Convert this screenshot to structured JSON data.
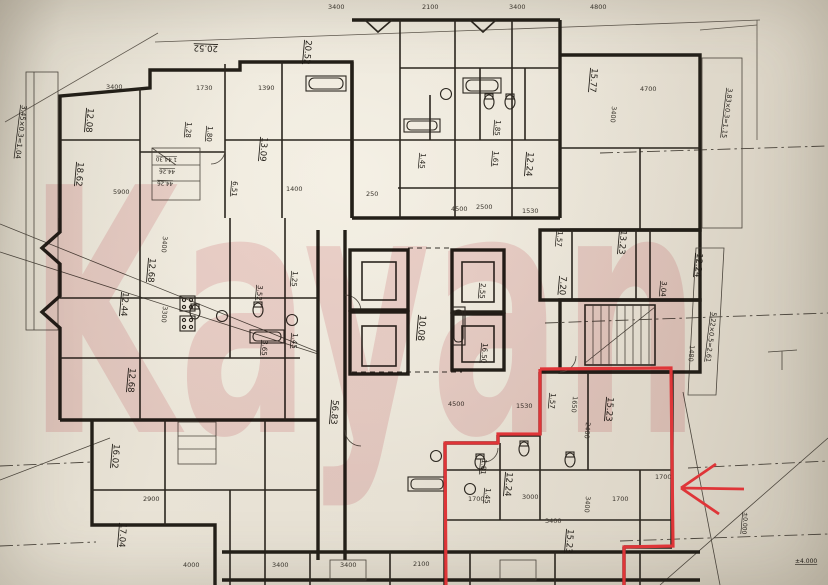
{
  "watermark": {
    "text": "Kayan",
    "color": "#e39da6",
    "opacity": "0.34"
  },
  "annotation": {
    "color": "#df3538"
  },
  "plan": {
    "room_labels": [
      {
        "t": "3.45×0.3=1.04",
        "x": 22,
        "y": 105,
        "r": 97,
        "s": 7
      },
      {
        "t": "12.08",
        "x": 88,
        "y": 108,
        "r": 95,
        "s": 8.5
      },
      {
        "t": "18.62",
        "x": 78,
        "y": 162,
        "r": 95,
        "s": 8.5
      },
      {
        "t": "1.28",
        "x": 187,
        "y": 122,
        "r": 95,
        "s": 7
      },
      {
        "t": "1.80",
        "x": 208,
        "y": 126,
        "r": 95,
        "s": 7
      },
      {
        "t": "13.09",
        "x": 262,
        "y": 137,
        "r": 95,
        "s": 8.5
      },
      {
        "t": "6.51",
        "x": 233,
        "y": 181,
        "r": 95,
        "s": 7
      },
      {
        "t": "20.52",
        "x": 218,
        "y": 46,
        "r": -178,
        "s": 8.5
      },
      {
        "t": "20.52",
        "x": 306,
        "y": 40,
        "r": 95,
        "s": 8.5
      },
      {
        "t": "1 44.30",
        "x": 177,
        "y": 158,
        "r": -178,
        "s": 5.5
      },
      {
        "t": "44.26",
        "x": 175,
        "y": 170,
        "r": -178,
        "s": 5.5
      },
      {
        "t": "44.26",
        "x": 173,
        "y": 182,
        "r": -178,
        "s": 5.5
      },
      {
        "t": "12.68",
        "x": 150,
        "y": 258,
        "r": 95,
        "s": 8.5
      },
      {
        "t": "12.44",
        "x": 123,
        "y": 292,
        "r": 95,
        "s": 8.5
      },
      {
        "t": "12.68",
        "x": 130,
        "y": 368,
        "r": 95,
        "s": 8.5
      },
      {
        "t": "3.52",
        "x": 258,
        "y": 285,
        "r": 95,
        "s": 7
      },
      {
        "t": "1.25",
        "x": 293,
        "y": 271,
        "r": 95,
        "s": 7
      },
      {
        "t": "3.65",
        "x": 263,
        "y": 340,
        "r": 95,
        "s": 7
      },
      {
        "t": "1.45",
        "x": 293,
        "y": 333,
        "r": 95,
        "s": 7
      },
      {
        "t": "56.83",
        "x": 333,
        "y": 400,
        "r": 95,
        "s": 8.5
      },
      {
        "t": "10.08",
        "x": 420,
        "y": 315,
        "r": 95,
        "s": 9
      },
      {
        "t": "2.55",
        "x": 481,
        "y": 283,
        "r": 95,
        "s": 7
      },
      {
        "t": "16.50",
        "x": 483,
        "y": 343,
        "r": 95,
        "s": 7
      },
      {
        "t": "1.85",
        "x": 496,
        "y": 120,
        "r": 95,
        "s": 7
      },
      {
        "t": "1.61",
        "x": 494,
        "y": 151,
        "r": 95,
        "s": 7
      },
      {
        "t": "1.45",
        "x": 421,
        "y": 153,
        "r": 95,
        "s": 7
      },
      {
        "t": "12.24",
        "x": 528,
        "y": 152,
        "r": 95,
        "s": 8.5
      },
      {
        "t": "15.77",
        "x": 592,
        "y": 68,
        "r": 95,
        "s": 8.5
      },
      {
        "t": "1.57",
        "x": 558,
        "y": 231,
        "r": 95,
        "s": 7
      },
      {
        "t": "7.20",
        "x": 561,
        "y": 276,
        "r": 95,
        "s": 8.5
      },
      {
        "t": "13.23",
        "x": 621,
        "y": 230,
        "r": 95,
        "s": 8.5
      },
      {
        "t": "3.04",
        "x": 662,
        "y": 281,
        "r": 95,
        "s": 7
      },
      {
        "t": "12.24",
        "x": 697,
        "y": 253,
        "r": 95,
        "s": 8.5
      },
      {
        "t": "5.22×0.5=2.61",
        "x": 712,
        "y": 312,
        "r": 97,
        "s": 6.5
      },
      {
        "t": "3.83×0.3=1.15",
        "x": 728,
        "y": 88,
        "r": 97,
        "s": 6.5
      },
      {
        "t": "1.81",
        "x": 482,
        "y": 459,
        "r": 95,
        "s": 7
      },
      {
        "t": "1.45",
        "x": 486,
        "y": 488,
        "r": 95,
        "s": 7
      },
      {
        "t": "12.24",
        "x": 507,
        "y": 472,
        "r": 95,
        "s": 8.5
      },
      {
        "t": "1.57",
        "x": 551,
        "y": 393,
        "r": 95,
        "s": 7
      },
      {
        "t": "15.23",
        "x": 608,
        "y": 397,
        "r": 95,
        "s": 8.5
      },
      {
        "t": "15.23",
        "x": 568,
        "y": 529,
        "r": 95,
        "s": 8.5
      },
      {
        "t": "16.02",
        "x": 114,
        "y": 444,
        "r": 95,
        "s": 8.5
      },
      {
        "t": "17.04",
        "x": 121,
        "y": 523,
        "r": 95,
        "s": 8.5
      },
      {
        "t": "±0.000",
        "x": 744,
        "y": 512,
        "r": 95,
        "s": 6
      },
      {
        "t": "±4.000",
        "x": 795,
        "y": 563,
        "r": 0,
        "s": 6
      }
    ],
    "dim_labels": [
      {
        "t": "3400",
        "x": 106,
        "y": 89,
        "r": 0
      },
      {
        "t": "1730",
        "x": 196,
        "y": 90,
        "r": 0
      },
      {
        "t": "1390",
        "x": 258,
        "y": 90,
        "r": 0
      },
      {
        "t": "3400",
        "x": 328,
        "y": 9,
        "r": 0
      },
      {
        "t": "2100",
        "x": 422,
        "y": 9,
        "r": 0
      },
      {
        "t": "3400",
        "x": 509,
        "y": 9,
        "r": 0
      },
      {
        "t": "4800",
        "x": 590,
        "y": 9,
        "r": 0
      },
      {
        "t": "4500",
        "x": 451,
        "y": 211,
        "r": 0
      },
      {
        "t": "2500",
        "x": 476,
        "y": 209,
        "r": 0
      },
      {
        "t": "1530",
        "x": 522,
        "y": 213,
        "r": 0
      },
      {
        "t": "5900",
        "x": 113,
        "y": 194,
        "r": 0
      },
      {
        "t": "1400",
        "x": 286,
        "y": 191,
        "r": 0
      },
      {
        "t": "3400",
        "x": 163,
        "y": 236,
        "r": 95
      },
      {
        "t": "3300",
        "x": 163,
        "y": 306,
        "r": 95
      },
      {
        "t": "2900",
        "x": 143,
        "y": 501,
        "r": 0
      },
      {
        "t": "4000",
        "x": 183,
        "y": 567,
        "r": 0
      },
      {
        "t": "4500",
        "x": 448,
        "y": 406,
        "r": 0
      },
      {
        "t": "1530",
        "x": 516,
        "y": 408,
        "r": 0
      },
      {
        "t": "1650",
        "x": 573,
        "y": 396,
        "r": 95
      },
      {
        "t": "2400",
        "x": 586,
        "y": 422,
        "r": 95
      },
      {
        "t": "3400",
        "x": 586,
        "y": 496,
        "r": 95
      },
      {
        "t": "1700",
        "x": 468,
        "y": 501,
        "r": 0
      },
      {
        "t": "3000",
        "x": 522,
        "y": 499,
        "r": 0
      },
      {
        "t": "1700",
        "x": 612,
        "y": 501,
        "r": 0
      },
      {
        "t": "3400",
        "x": 272,
        "y": 567,
        "r": 0
      },
      {
        "t": "3400",
        "x": 340,
        "y": 567,
        "r": 0
      },
      {
        "t": "2100",
        "x": 413,
        "y": 566,
        "r": 0
      },
      {
        "t": "3400",
        "x": 545,
        "y": 523,
        "r": 0
      },
      {
        "t": "4700",
        "x": 640,
        "y": 91,
        "r": 0
      },
      {
        "t": "3400",
        "x": 612,
        "y": 106,
        "r": 95
      },
      {
        "t": "1700",
        "x": 655,
        "y": 479,
        "r": 0
      },
      {
        "t": "250",
        "x": 366,
        "y": 196,
        "r": 0
      },
      {
        "t": "1480",
        "x": 690,
        "y": 345,
        "r": 95
      }
    ]
  }
}
